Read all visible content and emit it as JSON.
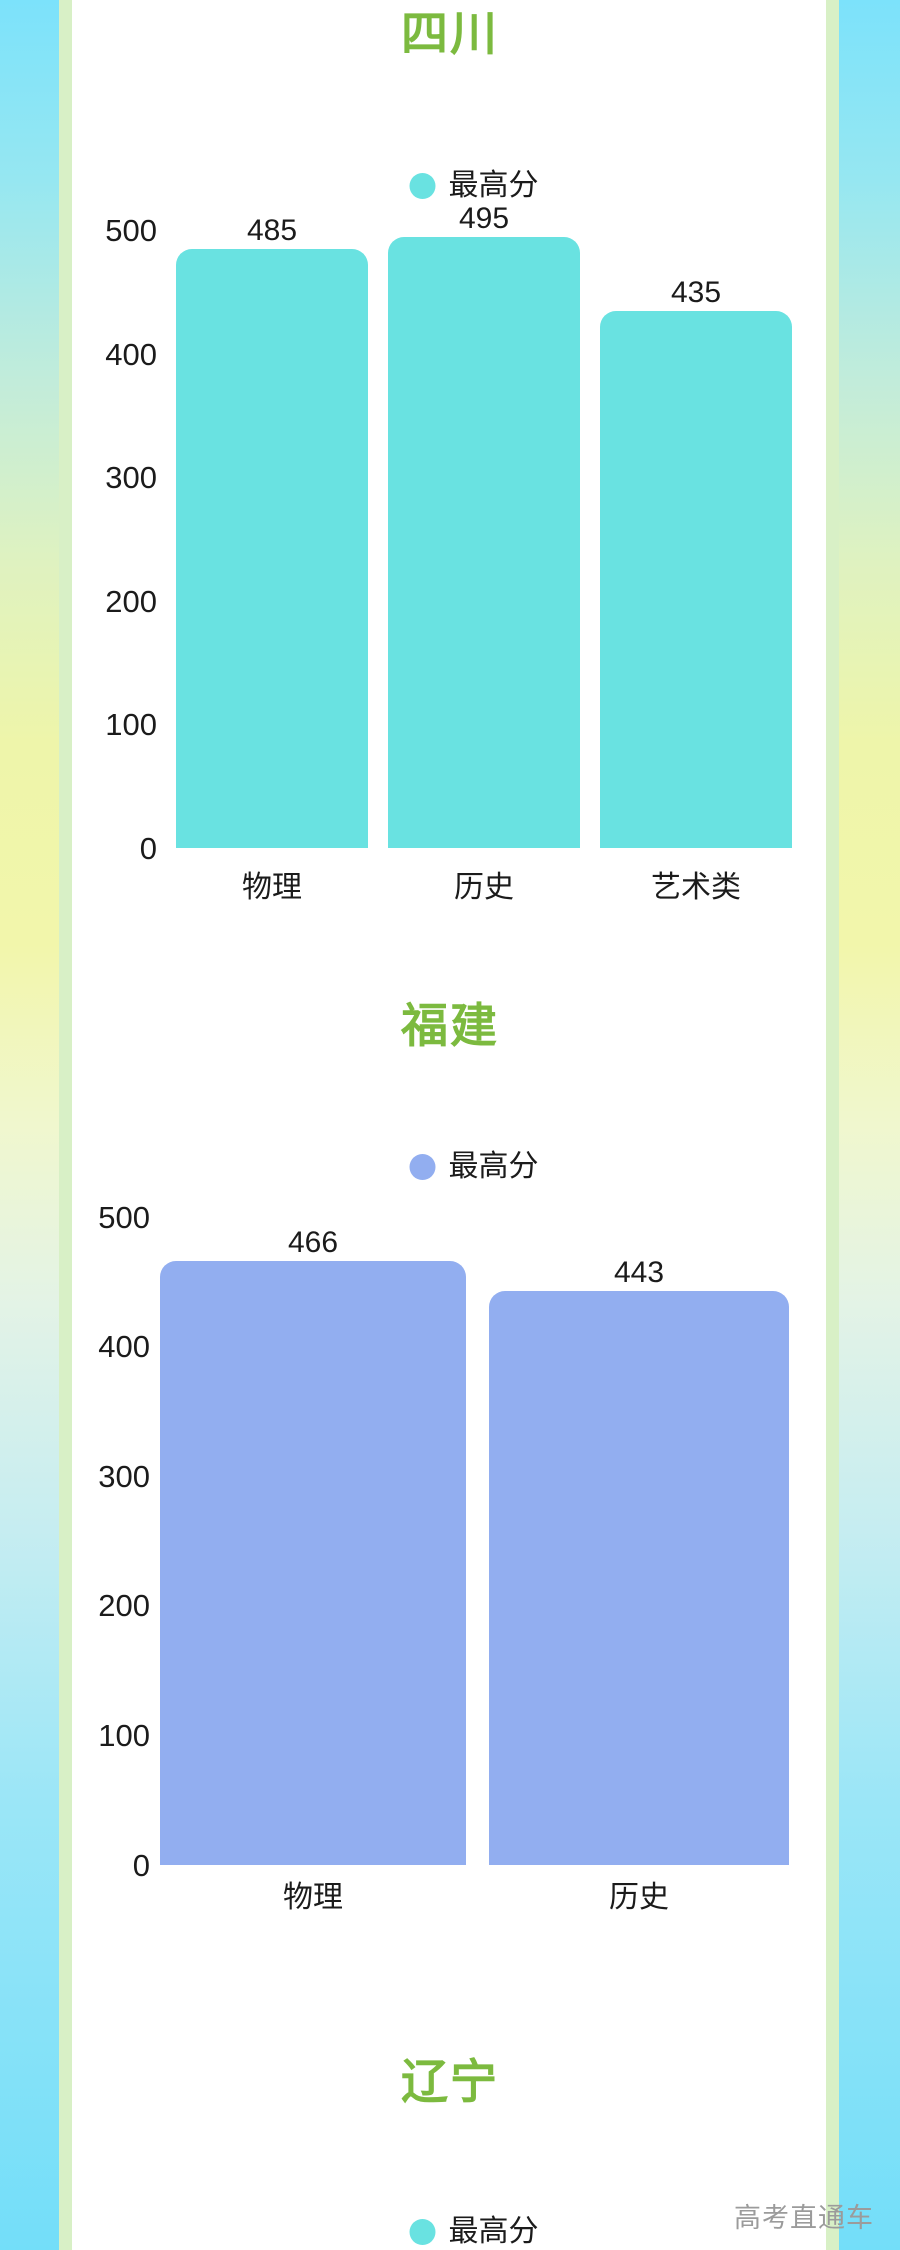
{
  "page": {
    "watermark": "高考直通车",
    "colors": {
      "title_green": "#7CBA3F",
      "cyan": "#69E2E1",
      "periwinkle": "#92AEF0",
      "text_dark": "#1B1B1B",
      "watermark_gray": "#9B9B9B",
      "bg_top_blue": "#7CE2FB",
      "bg_middle_yellow": "#F2F6AB",
      "bg_bottom_blue": "#73DEF9",
      "border_strip_green": "#D8F0C6",
      "card_white": "#FFFFFF"
    }
  },
  "chart_data": [
    {
      "type": "bar",
      "title": "四川",
      "legend": "最高分",
      "legend_position": "top-center",
      "legend_color": "#69E2E1",
      "bar_color": "#69E2E1",
      "categories": [
        "物理",
        "历史",
        "艺术类"
      ],
      "values": [
        485,
        495,
        435
      ],
      "value_labels": [
        "485",
        "495",
        "435"
      ],
      "y_ticks": [
        0,
        100,
        200,
        300,
        400,
        500
      ],
      "ylim": [
        0,
        500
      ],
      "grid": false
    },
    {
      "type": "bar",
      "title": "福建",
      "legend": "最高分",
      "legend_position": "top-center",
      "legend_color": "#92AEF0",
      "bar_color": "#92AEF0",
      "categories": [
        "物理",
        "历史"
      ],
      "values": [
        466,
        443
      ],
      "value_labels": [
        "466",
        "443"
      ],
      "y_ticks": [
        0,
        100,
        200,
        300,
        400,
        500
      ],
      "ylim": [
        0,
        500
      ],
      "grid": false
    },
    {
      "type": "bar",
      "title": "辽宁",
      "legend": "最高分",
      "legend_position": "top-center",
      "legend_color": "#69E2E1",
      "categories": [],
      "values": [],
      "y_ticks": [],
      "ylim": [
        0,
        500
      ],
      "grid": false
    }
  ]
}
